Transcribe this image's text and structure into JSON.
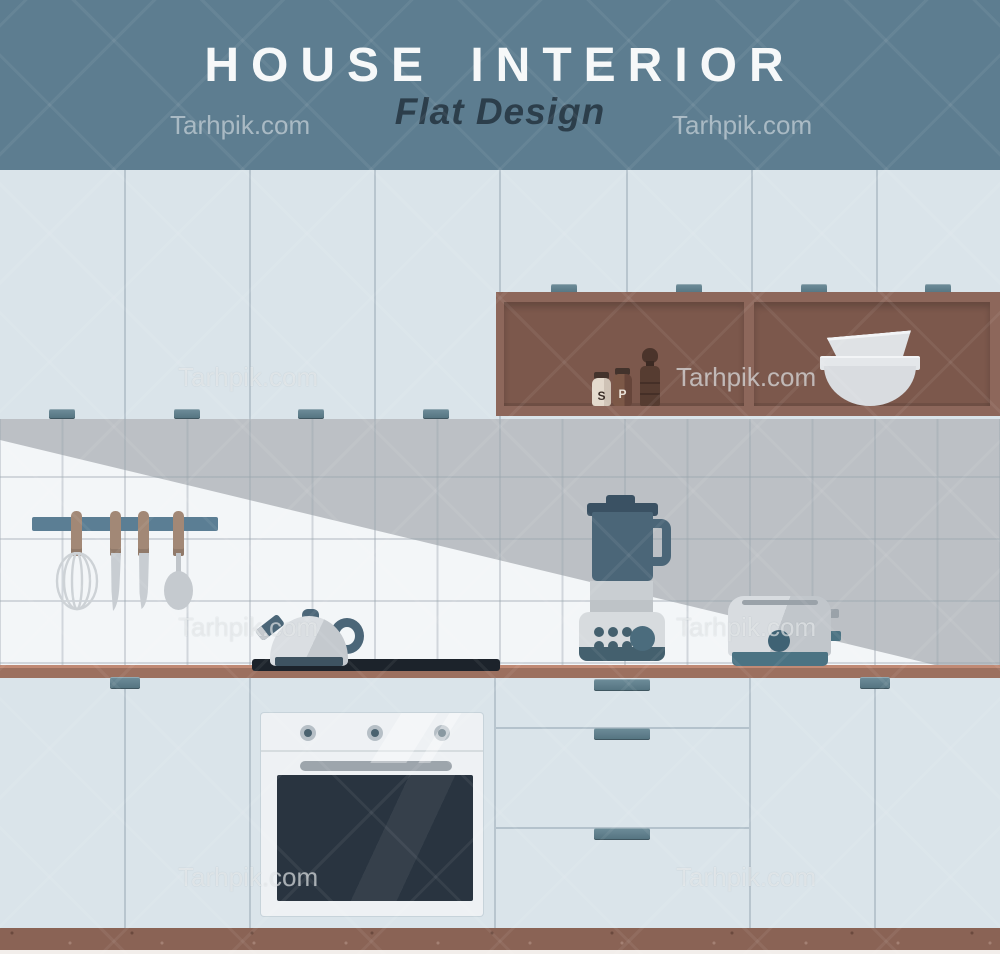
{
  "poster": {
    "title": "HOUSE INTERIOR",
    "subtitle": "Flat Design",
    "watermark": "Tarhpik.com"
  },
  "labels": {
    "salt": "S",
    "pepper": "P"
  },
  "palette": {
    "banner": "#5d7d90",
    "title_text": "#f6f8f9",
    "subtitle_text": "#2c3e4b",
    "cabinets": "#dae4ea",
    "handles": "#53727f",
    "shelf_wood": "#8d675b",
    "shelf_recess": "#7c584c",
    "tile_light": "#f3f6f8",
    "tile_shadow": "#bcc0c5",
    "countertop": "#9c705f",
    "kickboard": "#8a6355",
    "appliance_steel": "#d3d8dc",
    "appliance_slate": "#4b6678",
    "oven_window": "#293440",
    "cooktop": "#1c232b"
  },
  "scene_objects": [
    "upper-cabinets",
    "spice-shelf",
    "salt-shaker",
    "pepper-shaker",
    "pepper-grinder",
    "mixing-bowls",
    "tile-backsplash",
    "light-wedge",
    "utensil-rail",
    "whisk",
    "knife",
    "knife",
    "spoon",
    "kettle",
    "cooktop",
    "blender",
    "toaster",
    "countertop",
    "lower-cabinets",
    "drawer-unit",
    "oven",
    "kickboard",
    "floor"
  ]
}
